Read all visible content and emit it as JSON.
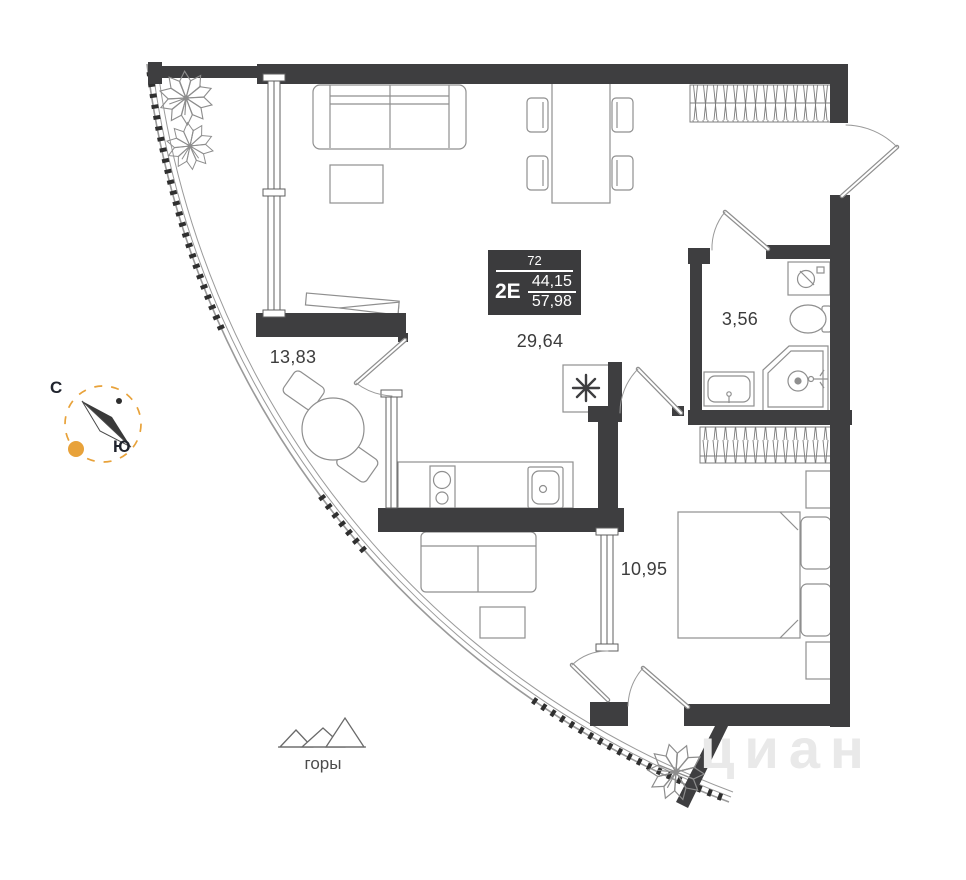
{
  "unit_card": {
    "floor": "72",
    "type": "2E",
    "area_upper": "44,15",
    "area_lower": "57,98"
  },
  "rooms": [
    {
      "id": "room-1",
      "area": "13,83"
    },
    {
      "id": "room-2",
      "area": "29,64"
    },
    {
      "id": "room-3",
      "area": "3,56"
    },
    {
      "id": "room-4",
      "area": "10,95"
    }
  ],
  "compass": {
    "north": "С",
    "south": "Ю"
  },
  "landmark": {
    "label": "горы"
  },
  "watermark": {
    "text": "циан"
  },
  "icons": [
    "compass-icon",
    "mountains-icon",
    "vent-asterisk-icon",
    "plant-icon",
    "cooktop-icon",
    "kitchen-sink-icon",
    "washing-machine-icon",
    "toilet-icon",
    "shower-icon",
    "vanity-sink-icon"
  ],
  "colors": {
    "wall": "#3e3e40",
    "furniture_line": "#8f8f8f",
    "accent_orange": "#e8a23a",
    "label_text": "#3c3c3c",
    "watermark_gray": "#e9e9e9"
  }
}
